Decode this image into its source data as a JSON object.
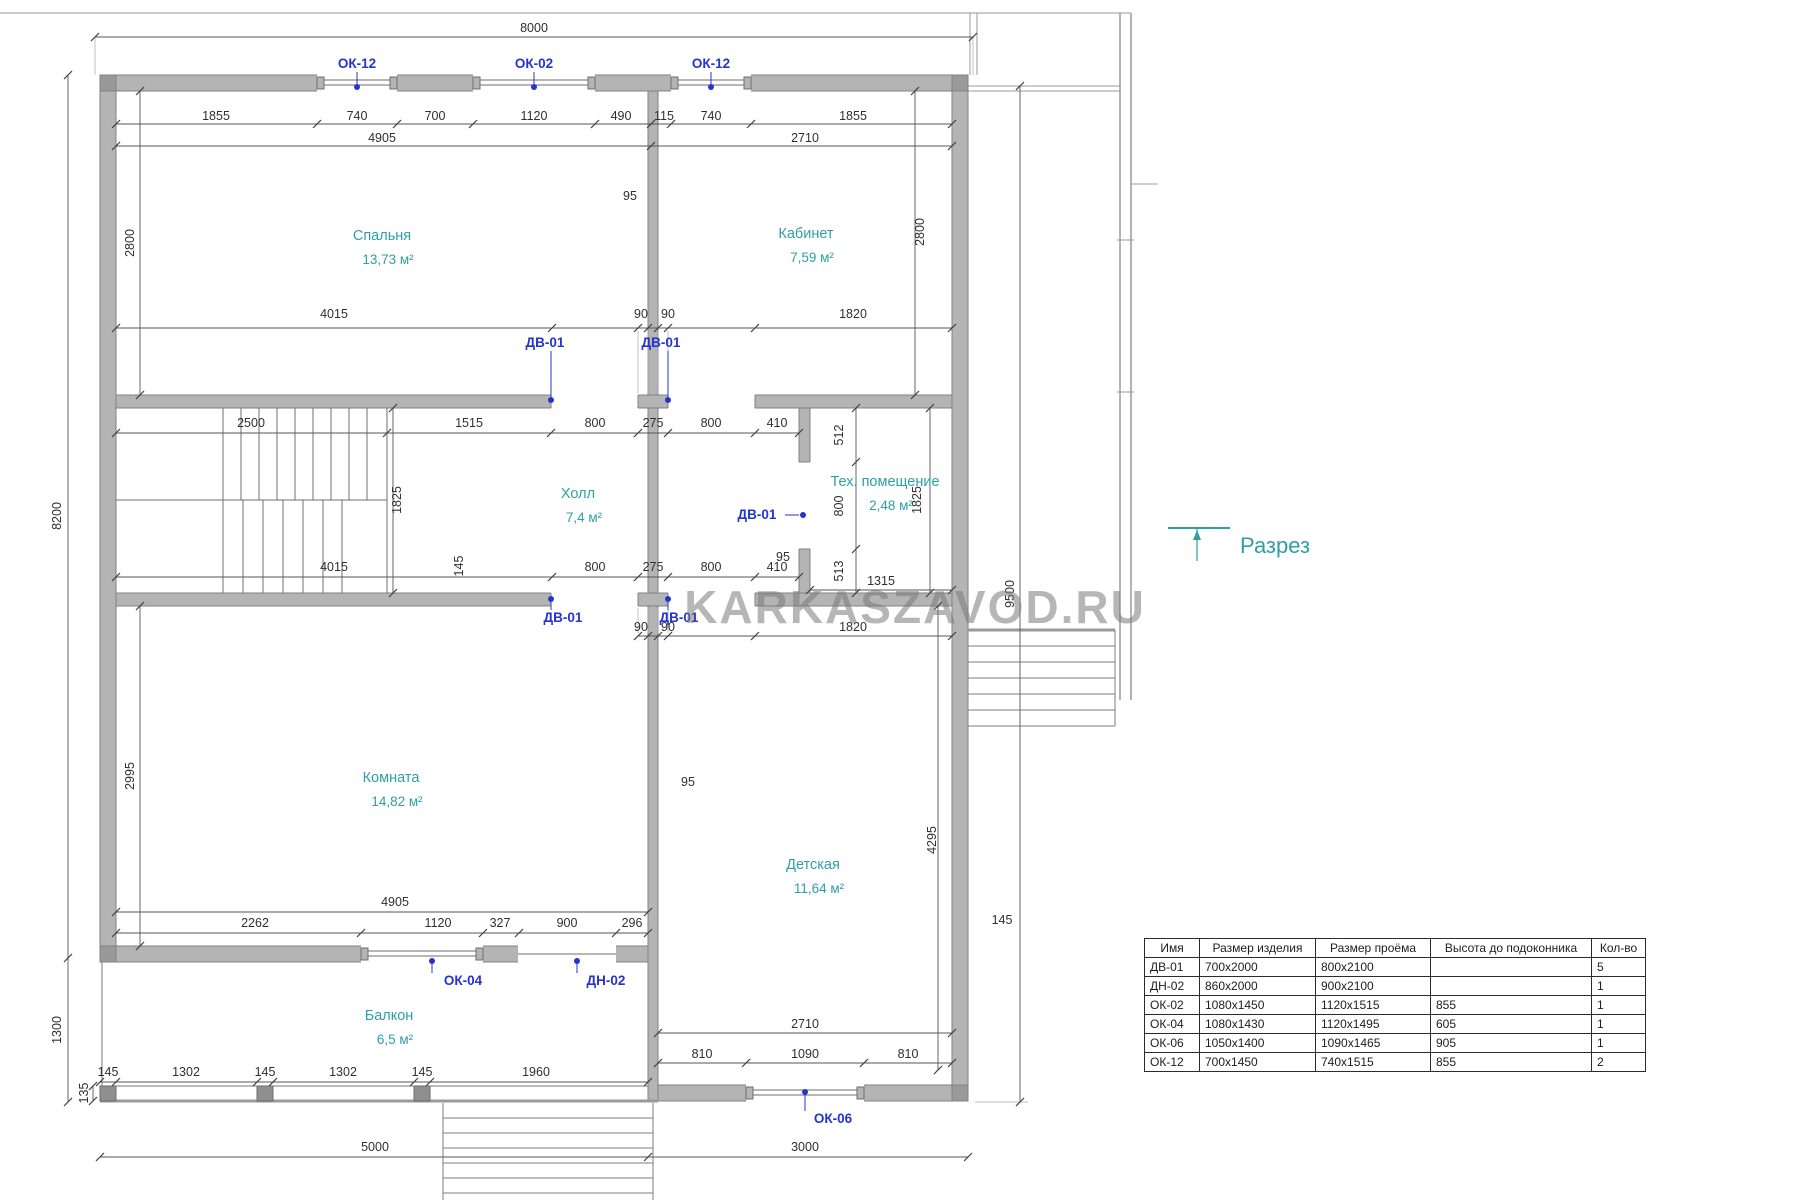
{
  "watermark": "KARKASZAVOD.RU",
  "section": {
    "label": "Разрез"
  },
  "rooms": [
    {
      "name": "Спальня",
      "area": "13,73 м²",
      "x": 382,
      "y": 240
    },
    {
      "name": "Кабинет",
      "area": "7,59 м²",
      "x": 806,
      "y": 238
    },
    {
      "name": "Холл",
      "area": "7,4 м²",
      "x": 578,
      "y": 498
    },
    {
      "name": "Тех. помещение",
      "area": "2,48 м²",
      "x": 885,
      "y": 486
    },
    {
      "name": "Комната",
      "area": "14,82 м²",
      "x": 391,
      "y": 782
    },
    {
      "name": "Детская",
      "area": "11,64 м²",
      "x": 813,
      "y": 869
    },
    {
      "name": "Балкон",
      "area": "6,5 м²",
      "x": 389,
      "y": 1020
    }
  ],
  "dims_horizontal": [
    {
      "t": "8000",
      "x": 534,
      "y": 32
    },
    {
      "t": "1855",
      "x": 216,
      "y": 120
    },
    {
      "t": "740",
      "x": 357,
      "y": 120
    },
    {
      "t": "700",
      "x": 435,
      "y": 120
    },
    {
      "t": "1120",
      "x": 534,
      "y": 120
    },
    {
      "t": "490",
      "x": 621,
      "y": 120
    },
    {
      "t": "115",
      "x": 664,
      "y": 120
    },
    {
      "t": "740",
      "x": 711,
      "y": 120
    },
    {
      "t": "1855",
      "x": 853,
      "y": 120
    },
    {
      "t": "4905",
      "x": 382,
      "y": 142
    },
    {
      "t": "2710",
      "x": 805,
      "y": 142
    },
    {
      "t": "95",
      "x": 630,
      "y": 200
    },
    {
      "t": "4015",
      "x": 334,
      "y": 318
    },
    {
      "t": "90",
      "x": 641,
      "y": 318
    },
    {
      "t": "90",
      "x": 668,
      "y": 318
    },
    {
      "t": "1820",
      "x": 853,
      "y": 318
    },
    {
      "t": "2500",
      "x": 251,
      "y": 427
    },
    {
      "t": "1515",
      "x": 469,
      "y": 427
    },
    {
      "t": "800",
      "x": 595,
      "y": 427
    },
    {
      "t": "275",
      "x": 653,
      "y": 427
    },
    {
      "t": "800",
      "x": 711,
      "y": 427
    },
    {
      "t": "410",
      "x": 777,
      "y": 427
    },
    {
      "t": "95",
      "x": 783,
      "y": 561
    },
    {
      "t": "4015",
      "x": 334,
      "y": 571
    },
    {
      "t": "800",
      "x": 595,
      "y": 571
    },
    {
      "t": "275",
      "x": 653,
      "y": 571
    },
    {
      "t": "800",
      "x": 711,
      "y": 571
    },
    {
      "t": "410",
      "x": 777,
      "y": 571
    },
    {
      "t": "1315",
      "x": 881,
      "y": 585
    },
    {
      "t": "90",
      "x": 641,
      "y": 631
    },
    {
      "t": "90",
      "x": 668,
      "y": 631
    },
    {
      "t": "1820",
      "x": 853,
      "y": 631
    },
    {
      "t": "95",
      "x": 688,
      "y": 786
    },
    {
      "t": "4905",
      "x": 395,
      "y": 906
    },
    {
      "t": "2262",
      "x": 255,
      "y": 927
    },
    {
      "t": "1120",
      "x": 438,
      "y": 927
    },
    {
      "t": "327",
      "x": 500,
      "y": 927
    },
    {
      "t": "900",
      "x": 567,
      "y": 927
    },
    {
      "t": "296",
      "x": 632,
      "y": 927
    },
    {
      "t": "145",
      "x": 1002,
      "y": 924
    },
    {
      "t": "2710",
      "x": 805,
      "y": 1028
    },
    {
      "t": "810",
      "x": 702,
      "y": 1058
    },
    {
      "t": "1090",
      "x": 805,
      "y": 1058
    },
    {
      "t": "810",
      "x": 908,
      "y": 1058
    },
    {
      "t": "145",
      "x": 108,
      "y": 1076
    },
    {
      "t": "1302",
      "x": 186,
      "y": 1076
    },
    {
      "t": "145",
      "x": 265,
      "y": 1076
    },
    {
      "t": "1302",
      "x": 343,
      "y": 1076
    },
    {
      "t": "145",
      "x": 422,
      "y": 1076
    },
    {
      "t": "1960",
      "x": 536,
      "y": 1076
    },
    {
      "t": "5000",
      "x": 375,
      "y": 1151
    },
    {
      "t": "3000",
      "x": 805,
      "y": 1151
    }
  ],
  "dims_vertical": [
    {
      "t": "2800",
      "x": 134,
      "y": 243
    },
    {
      "t": "8200",
      "x": 61,
      "y": 516
    },
    {
      "t": "2995",
      "x": 134,
      "y": 776
    },
    {
      "t": "1300",
      "x": 61,
      "y": 1030
    },
    {
      "t": "135",
      "x": 88,
      "y": 1093
    },
    {
      "t": "1825",
      "x": 401,
      "y": 500
    },
    {
      "t": "145",
      "x": 463,
      "y": 566
    },
    {
      "t": "512",
      "x": 843,
      "y": 435
    },
    {
      "t": "800",
      "x": 843,
      "y": 506
    },
    {
      "t": "513",
      "x": 843,
      "y": 571
    },
    {
      "t": "1825",
      "x": 921,
      "y": 500
    },
    {
      "t": "2800",
      "x": 924,
      "y": 232
    },
    {
      "t": "9500",
      "x": 1014,
      "y": 594
    },
    {
      "t": "4295",
      "x": 936,
      "y": 840
    }
  ],
  "opening_labels": [
    {
      "t": "ОК-12",
      "x": 357,
      "y": 68,
      "dx": 357,
      "dy": 87,
      "dir": "v"
    },
    {
      "t": "ОК-02",
      "x": 534,
      "y": 68,
      "dx": 534,
      "dy": 87,
      "dir": "v"
    },
    {
      "t": "ОК-12",
      "x": 711,
      "y": 68,
      "dx": 711,
      "dy": 87,
      "dir": "v"
    },
    {
      "t": "ДВ-01",
      "x": 545,
      "y": 347,
      "dx": 551,
      "dy": 400,
      "dir": "v"
    },
    {
      "t": "ДВ-01",
      "x": 661,
      "y": 347,
      "dx": 668,
      "dy": 400,
      "dir": "v"
    },
    {
      "t": "ДВ-01",
      "x": 757,
      "y": 519,
      "dx": 803,
      "dy": 515,
      "dir": "h"
    },
    {
      "t": "ДВ-01",
      "x": 563,
      "y": 622,
      "dx": 551,
      "dy": 599,
      "dir": "v"
    },
    {
      "t": "ДВ-01",
      "x": 679,
      "y": 622,
      "dx": 668,
      "dy": 599,
      "dir": "v"
    },
    {
      "t": "ОК-04",
      "x": 463,
      "y": 985,
      "dx": 432,
      "dy": 961,
      "dir": "v"
    },
    {
      "t": "ДН-02",
      "x": 606,
      "y": 985,
      "dx": 577,
      "dy": 961,
      "dir": "v"
    },
    {
      "t": "ОК-06",
      "x": 833,
      "y": 1123,
      "dx": 805,
      "dy": 1092,
      "dir": "v"
    }
  ],
  "spec_table": {
    "headers": [
      "Имя",
      "Размер изделия",
      "Размер проёма",
      "Высота до подоконника",
      "Кол-во"
    ],
    "rows": [
      [
        "ДВ-01",
        "700x2000",
        "800x2100",
        "",
        "5"
      ],
      [
        "ДН-02",
        "860x2000",
        "900x2100",
        "",
        "1"
      ],
      [
        "ОК-02",
        "1080x1450",
        "1120x1515",
        "855",
        "1"
      ],
      [
        "ОК-04",
        "1080x1430",
        "1120x1495",
        "605",
        "1"
      ],
      [
        "ОК-06",
        "1050x1400",
        "1090x1465",
        "905",
        "1"
      ],
      [
        "ОК-12",
        "700x1450",
        "740x1515",
        "855",
        "2"
      ]
    ]
  }
}
